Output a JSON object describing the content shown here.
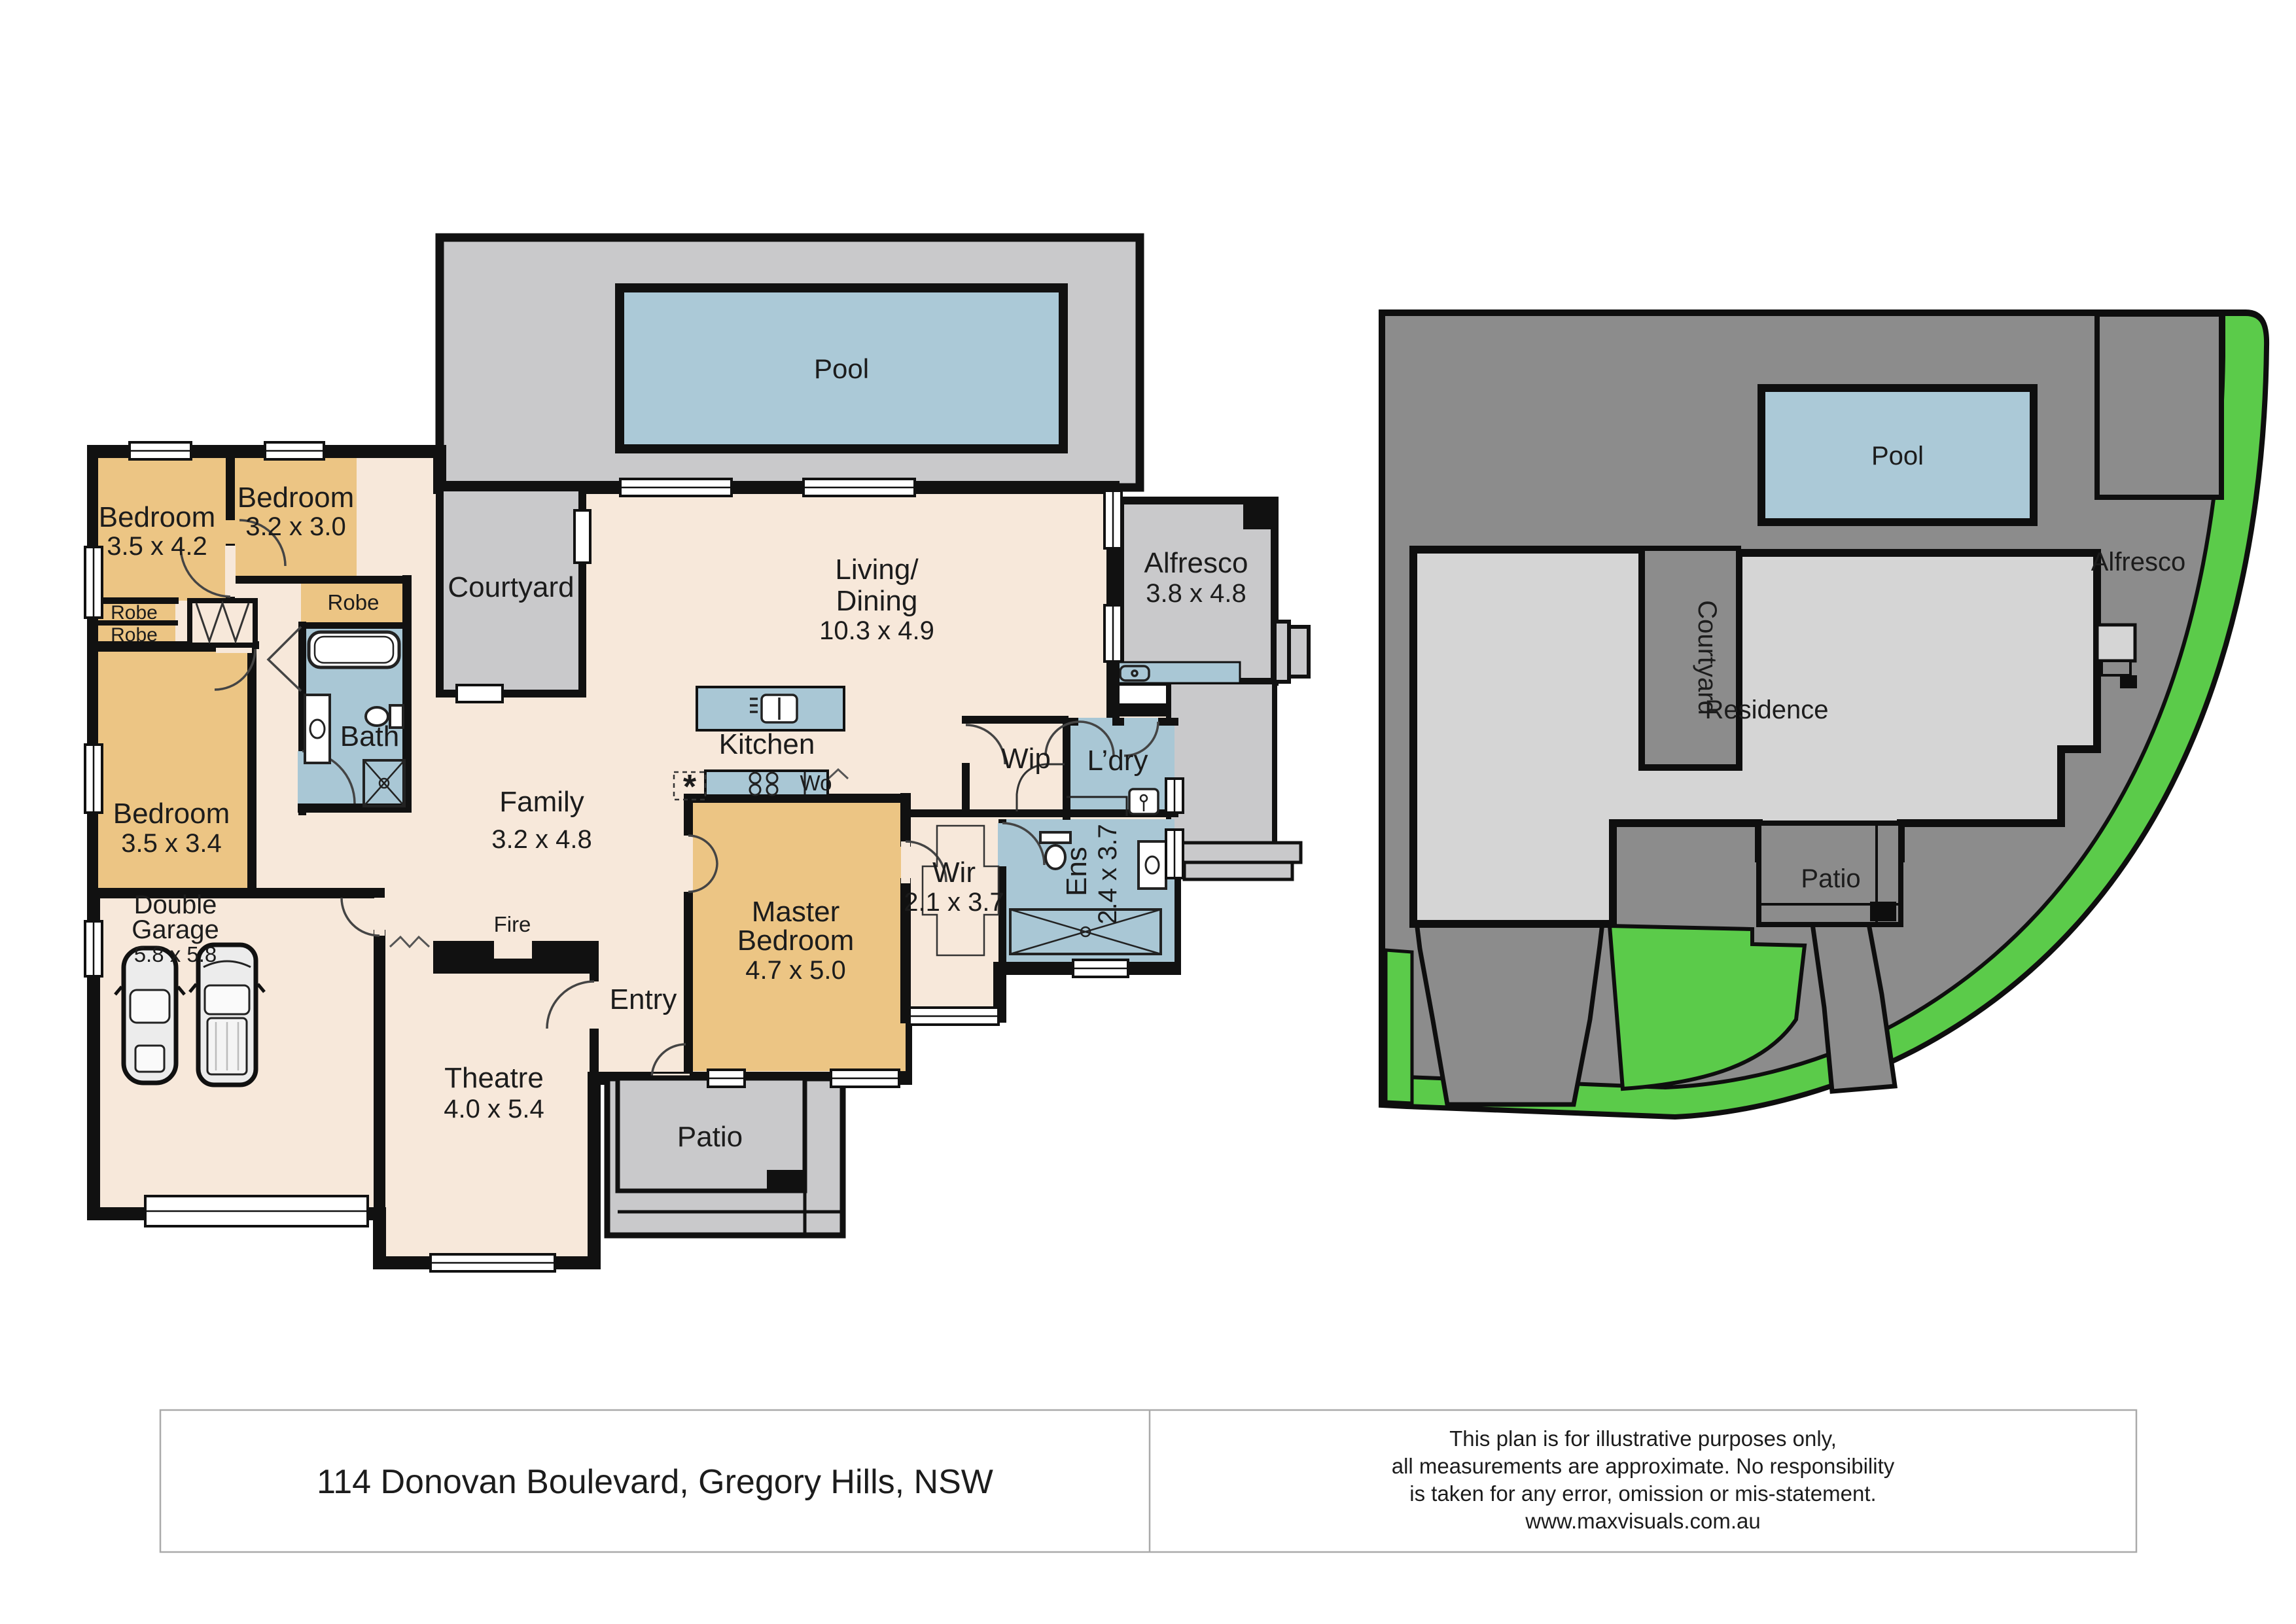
{
  "footer": {
    "address": "114 Donovan Boulevard, Gregory Hills, NSW",
    "disclaimer": [
      "This plan is for illustrative purposes only,",
      "all measurements are approximate. No responsibility",
      "is taken for any error, omission or mis-statement.",
      "www.maxvisuals.com.au"
    ]
  },
  "colors": {
    "wall": "#111111",
    "floor": "#f7e8da",
    "bedroom": "#ecc584",
    "wet": "#a9c7d5",
    "outdoor": "#c9c9cb",
    "site_dark": "#8c8c8c",
    "residence": "#d5d5d5",
    "grass": "#5bcb4a",
    "pool": "#abc9d7"
  },
  "floorplan": {
    "pool": {
      "name": "Pool"
    },
    "courtyard": {
      "name": "Courtyard"
    },
    "living": {
      "name1": "Living/",
      "name2": "Dining",
      "dims": "10.3 x 4.9"
    },
    "alfresco": {
      "name": "Alfresco",
      "dims": "3.8 x 4.8"
    },
    "bedroom1": {
      "name": "Bedroom",
      "dims": "3.5 x 4.2"
    },
    "bedroom2": {
      "name": "Bedroom",
      "dims": "3.2 x 3.0"
    },
    "bedroom3": {
      "name": "Bedroom",
      "dims": "3.5 x 3.4"
    },
    "robe_bed2": {
      "name": "Robe"
    },
    "robe_a": {
      "name": "Robe"
    },
    "robe_b": {
      "name": "Robe"
    },
    "bath": {
      "name": "Bath"
    },
    "family": {
      "name": "Family",
      "dims": "3.2 x 4.8"
    },
    "kitchen": {
      "name": "Kitchen"
    },
    "oven": {
      "name": "Wo"
    },
    "pantry_star": "*",
    "wip": {
      "name": "Wip"
    },
    "laundry": {
      "name": "L’dry"
    },
    "wir": {
      "name": "Wir",
      "dims": "2.1 x 3.7"
    },
    "ens": {
      "name": "Ens",
      "dims": "2.4 x 3.7"
    },
    "master": {
      "name1": "Master",
      "name2": "Bedroom",
      "dims": "4.7 x 5.0"
    },
    "garage": {
      "name1": "Double",
      "name2": "Garage",
      "dims": "5.8 x 5.8"
    },
    "fire": {
      "name": "Fire"
    },
    "entry": {
      "name": "Entry"
    },
    "theatre": {
      "name": "Theatre",
      "dims": "4.0 x 5.4"
    },
    "patio": {
      "name": "Patio"
    }
  },
  "siteplan": {
    "pool": "Pool",
    "courtyard": "Courtyard",
    "alfresco": "Alfresco",
    "residence": "Residence",
    "patio": "Patio"
  }
}
